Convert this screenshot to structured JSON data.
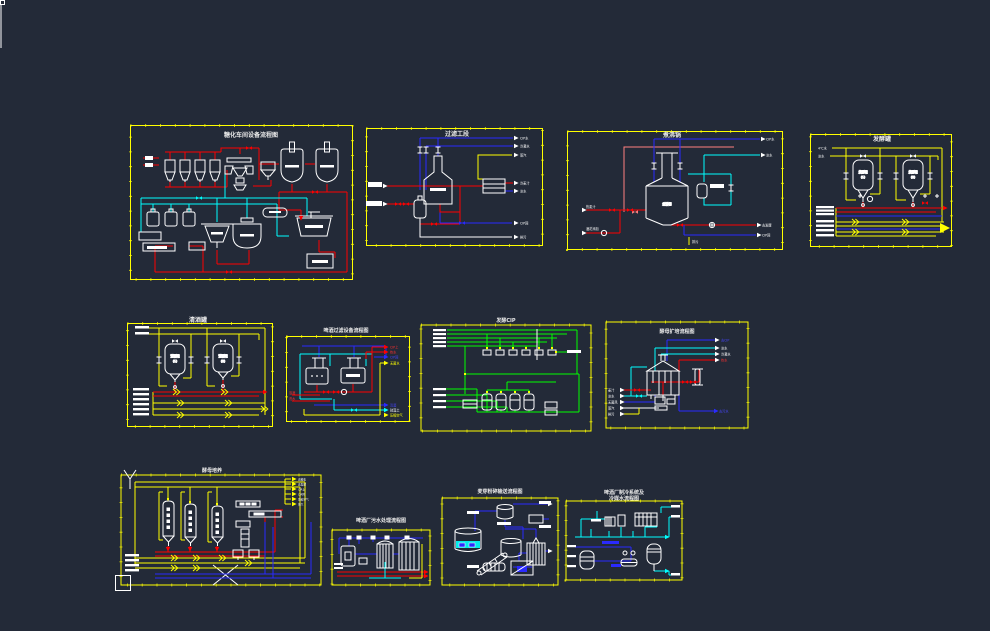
{
  "app": {
    "type": "cad-drawing-canvas",
    "background": "#232A38"
  },
  "palette": {
    "border_yellow": "#FFFF00",
    "pipe_red": "#FF0000",
    "pipe_blue": "#2A2AFF",
    "pipe_cyan": "#00FFFF",
    "pipe_green": "#00FF00",
    "pipe_yellow": "#FFFF00",
    "pipe_salmon": "#FF8080",
    "equipment_white": "#FFFFFF"
  },
  "panels": {
    "p1": {
      "title": "糖化车间设备流程图"
    },
    "p2": {
      "title": "过滤工段",
      "labels": [
        "CIP水",
        "冷凝水",
        "蒸汽",
        "冷麦汁",
        "冰水",
        "CIP回",
        "排污",
        "麦汁",
        "酒花"
      ]
    },
    "p3": {
      "title": "煮沸锅",
      "tank_label": "煮沸锅",
      "condenser_label": "冷凝器",
      "labels": [
        "CIP水",
        "冰水",
        "热麦汁",
        "酒花添加",
        "去发酵",
        "CIP回",
        "排污"
      ]
    },
    "p4": {
      "title": "发酵罐",
      "left_labels": [
        "4℃水",
        "冰水"
      ],
      "vessel1": "发酵罐",
      "vessel1n": "(1)",
      "vessel2": "发酵罐",
      "vessel2n": "(2)"
    },
    "p5": {
      "title": "清酒罐",
      "vessel1": "清酒罐",
      "vessel1n": "(1)",
      "vessel2": "清酒罐",
      "vessel2n": "(2)"
    },
    "p6": {
      "title": "啤酒过滤设备流程图",
      "right_labels": [
        "CIP上",
        "热水",
        "CIP回",
        "无菌水"
      ],
      "bottom_labels": [
        "清酒",
        "硅藻土",
        "压缩空气"
      ],
      "left_labels": [
        "浊酒",
        "洗水"
      ]
    },
    "p7": {
      "title": "发酵CIP"
    },
    "p8": {
      "title": "酵母扩培流程图",
      "right_labels": [
        "去CIP",
        "冰水",
        "冷凝水",
        "热水"
      ],
      "left_labels": [
        "麦汁",
        "冰水",
        "无菌风",
        "蒸汽",
        "排污"
      ],
      "bottom_label": "去污水"
    },
    "p9": {
      "title": "酵母培养",
      "right_labels": [
        "去糖化",
        "去发酵",
        "CIP上",
        "CIP回",
        "压缩空气",
        "蒸汽"
      ]
    },
    "p10": {
      "title": "啤酒厂污水处理流程图"
    },
    "p11": {
      "title": "麦芽粉碎输送流程图"
    },
    "p12": {
      "title_line1": "啤酒厂制冷系统及",
      "title_line2": "冷媒水流程图"
    }
  }
}
